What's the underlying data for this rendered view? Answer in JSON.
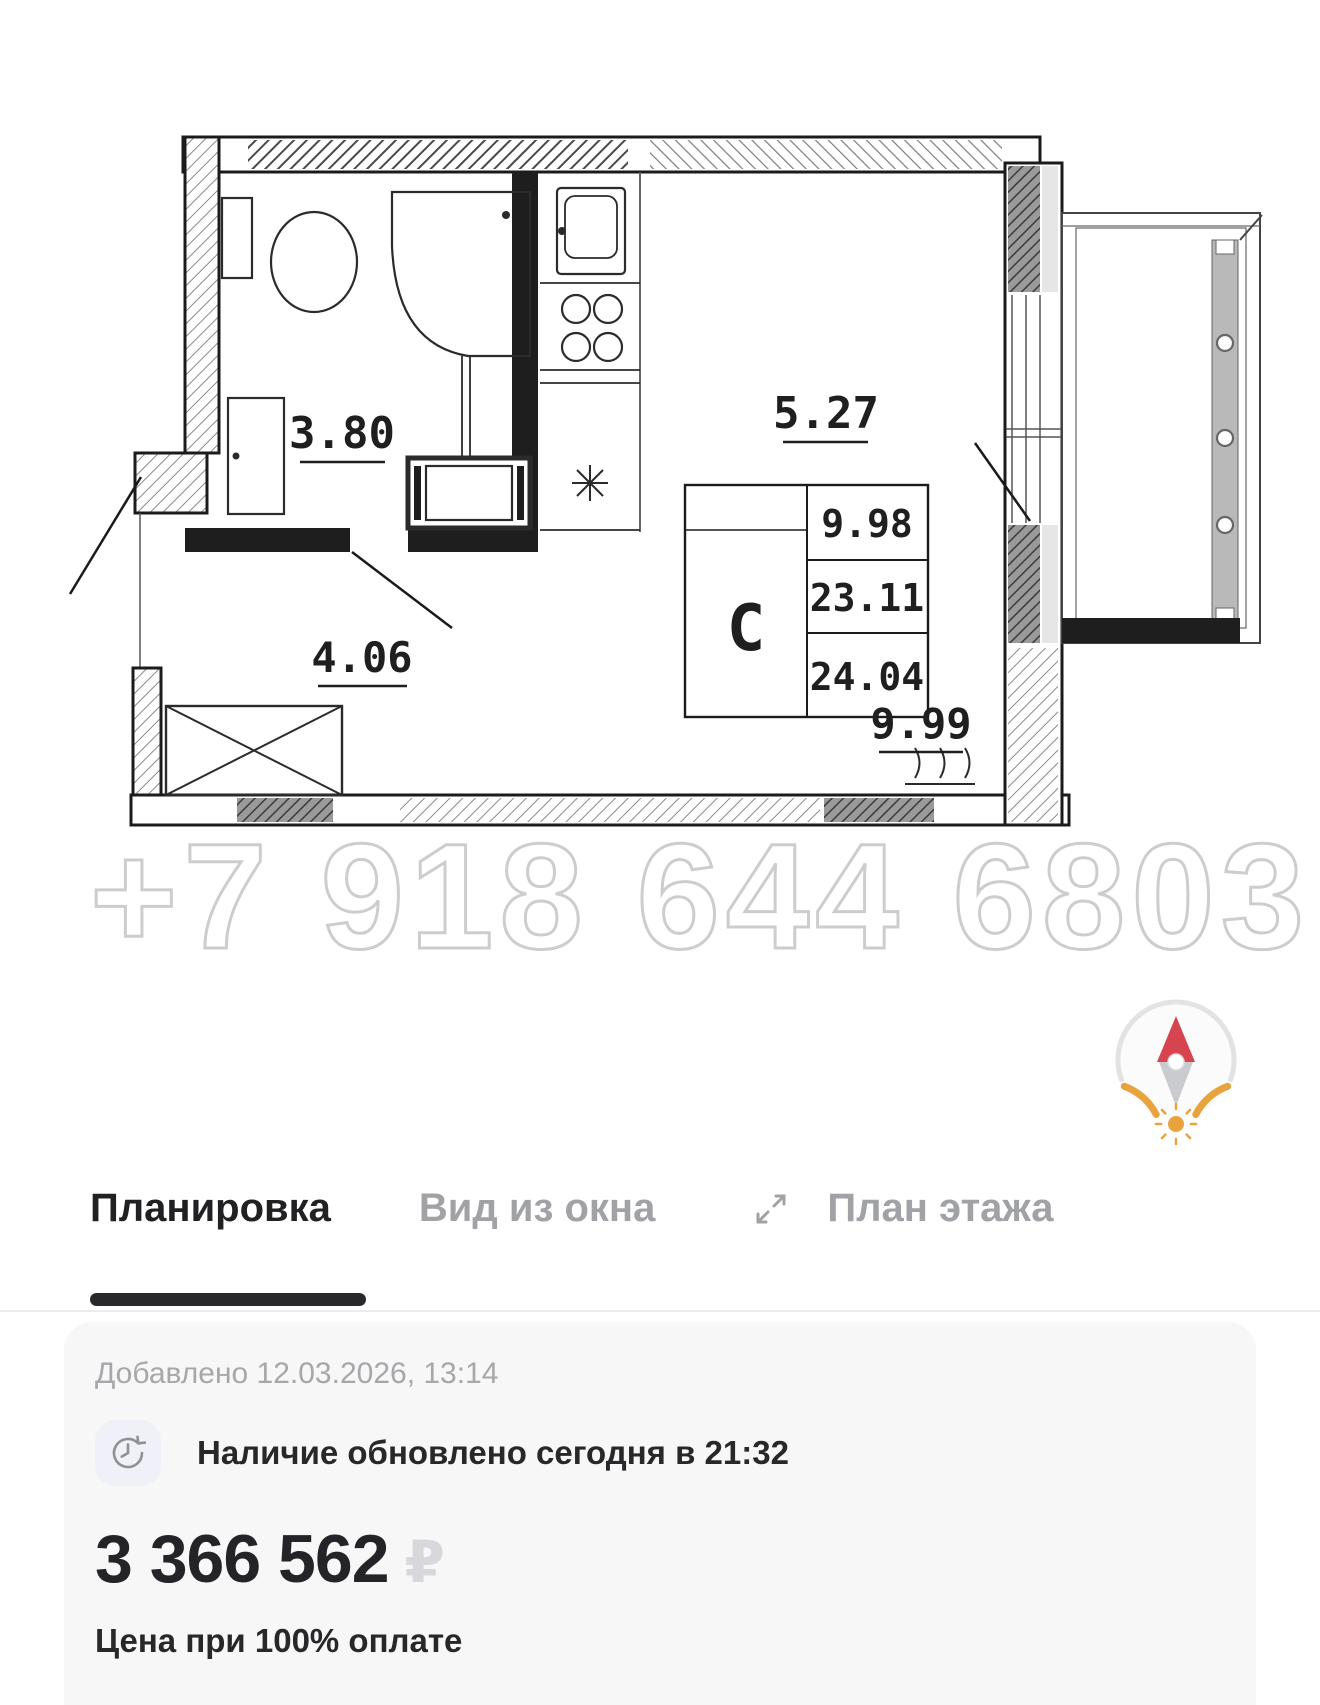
{
  "floor_plan": {
    "watermark": "+7 918 644 6803",
    "room_type_code": "С",
    "dimensions": {
      "bathroom": "3.80",
      "kitchen_zone": "5.27",
      "hallway": "4.06",
      "room": "9.99"
    },
    "info_table": {
      "values": [
        "9.98",
        "23.11",
        "24.04"
      ]
    }
  },
  "tabs": {
    "items": [
      {
        "label": "Планировка",
        "active": true
      },
      {
        "label": "Вид из окна",
        "active": false
      },
      {
        "label": "План этажа",
        "active": false
      }
    ]
  },
  "listing": {
    "added": "Добавлено 12.03.2026, 13:14",
    "availability": "Наличие обновлено сегодня в 21:32",
    "price": "3 366 562",
    "currency_symbol": "₽",
    "price_note": "Цена при 100% оплате"
  },
  "colors": {
    "accent_orange": "#E8A33D",
    "compass_red": "#D6454F",
    "watermark_gray": "#CDCDCD"
  }
}
